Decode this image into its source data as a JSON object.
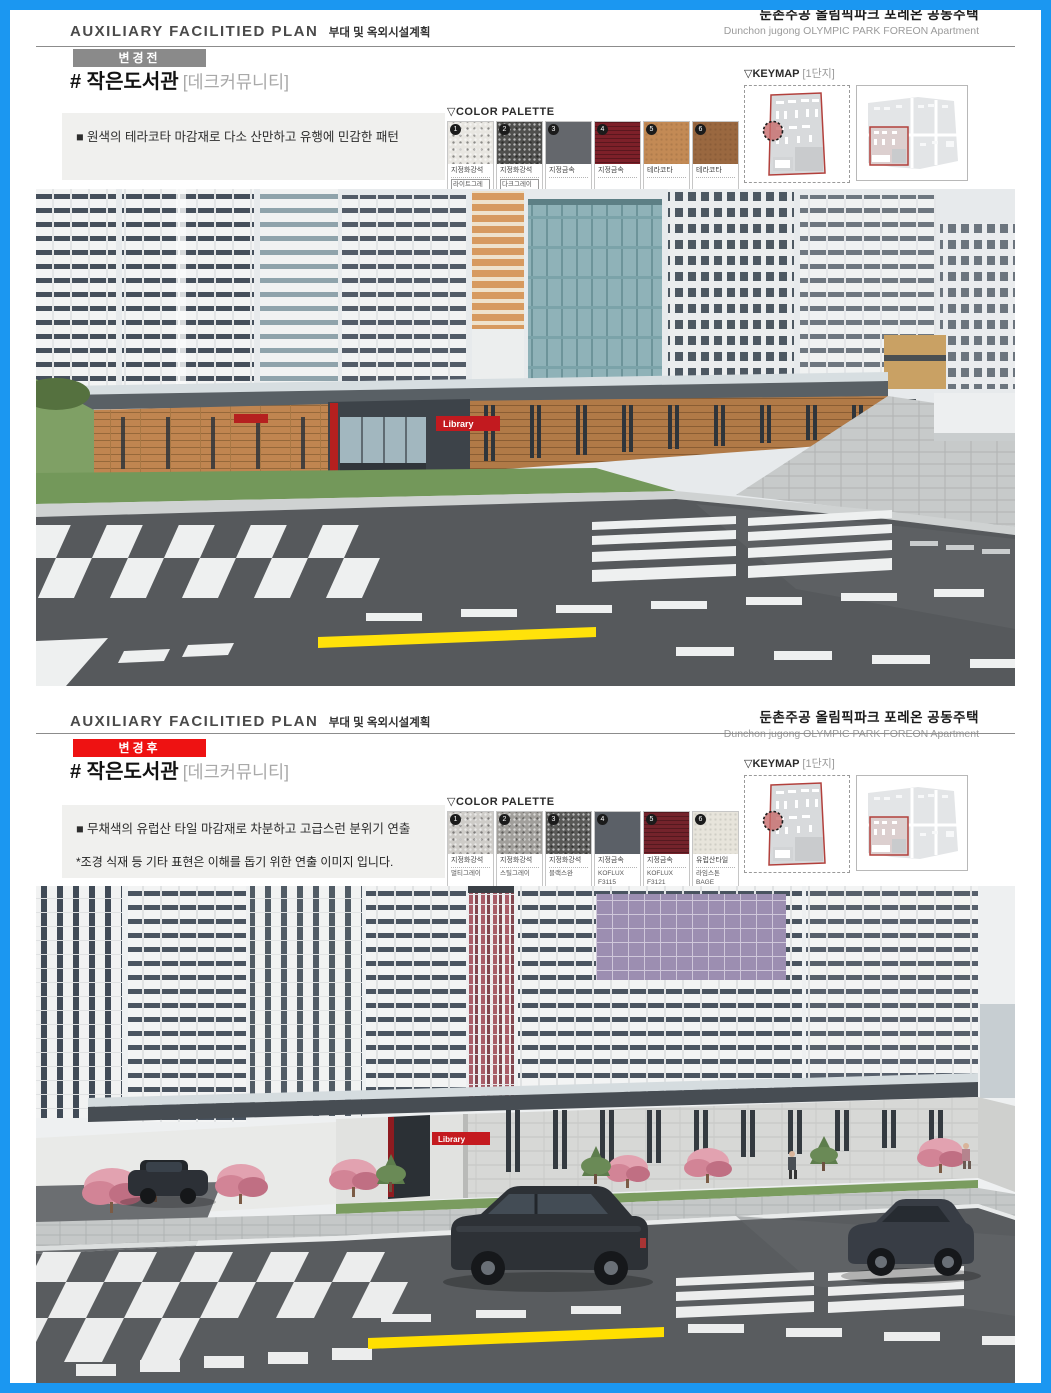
{
  "page": {
    "frame_color": "#1b97f1"
  },
  "panels": [
    {
      "header": {
        "plan_en": "AUXILIARY FACILITIED PLAN",
        "plan_ko": "부대 및 옥외시설계획",
        "project_ko": "둔촌주공 올림픽파크 포레온 공동주택",
        "project_en": "Dunchon jugong OLYMPIC PARK FOREON Apartment"
      },
      "badge": {
        "label": "변경전",
        "bg": "#8a8a8a"
      },
      "title": {
        "main": "# 작은도서관",
        "sub": "[데크커뮤니티]"
      },
      "note": {
        "line1": "■ 원색의 테라코타 마감재로 다소 산만하고 유행에 민감한 패턴",
        "line2": ""
      },
      "palette": {
        "title": "▽COLOR PALETTE",
        "swatches": [
          {
            "num": "1",
            "bg": "#e8e6e1",
            "name": "지정화강석",
            "sub": "라이트그레이계열"
          },
          {
            "num": "2",
            "bg": "#4f4f4d",
            "name": "지정화강석",
            "sub": "다크그레이계열"
          },
          {
            "num": "3",
            "bg": "#64676c",
            "name": "지정금속",
            "sub": ""
          },
          {
            "num": "4",
            "bg": "#7d2029",
            "name": "지정금속",
            "sub": ""
          },
          {
            "num": "5",
            "bg": "#c38a55",
            "name": "테라코타",
            "sub": ""
          },
          {
            "num": "6",
            "bg": "#9a6840",
            "name": "테라코타",
            "sub": ""
          }
        ]
      },
      "keymap": {
        "title": "▽KEYMAP",
        "tag": "[1단지]"
      },
      "render": {
        "sign": "Library"
      }
    },
    {
      "header": {
        "plan_en": "AUXILIARY FACILITIED PLAN",
        "plan_ko": "부대 및 옥외시설계획",
        "project_ko": "둔촌주공 올림픽파크 포레온 공동주택",
        "project_en": "Dunchon jugong OLYMPIC PARK FOREON Apartment"
      },
      "badge": {
        "label": "변경후",
        "bg": "#ee1212"
      },
      "title": {
        "main": "# 작은도서관",
        "sub": "[데크커뮤니티]"
      },
      "note": {
        "line1": "■ 무채색의 유럽산 타일 마감재로 차분하고 고급스런 분위기 연출",
        "line2": "*조경 식재  등 기타 표현은 이해를 돕기 위한 연출 이미지 입니다."
      },
      "palette": {
        "title": "▽COLOR PALETTE",
        "swatches": [
          {
            "num": "1",
            "bg": "#ceccc8",
            "name": "지정화강석",
            "sub": "멀티그레이"
          },
          {
            "num": "2",
            "bg": "#a19f9b",
            "name": "지정화강석",
            "sub": "스틸그레이"
          },
          {
            "num": "3",
            "bg": "#595957",
            "name": "지정화강석",
            "sub": "블랙스완"
          },
          {
            "num": "4",
            "bg": "#5b6067",
            "name": "지정금속",
            "sub": "KOFLUX F3115"
          },
          {
            "num": "5",
            "bg": "#74232b",
            "name": "지정금속",
            "sub": "KOFLUX F3121"
          },
          {
            "num": "6",
            "bg": "#e7e4db",
            "name": "유럽산타일",
            "sub": "라임스톤 BAGE"
          }
        ]
      },
      "keymap": {
        "title": "▽KEYMAP",
        "tag": "[1단지]"
      },
      "render": {
        "sign": "Library"
      }
    }
  ]
}
